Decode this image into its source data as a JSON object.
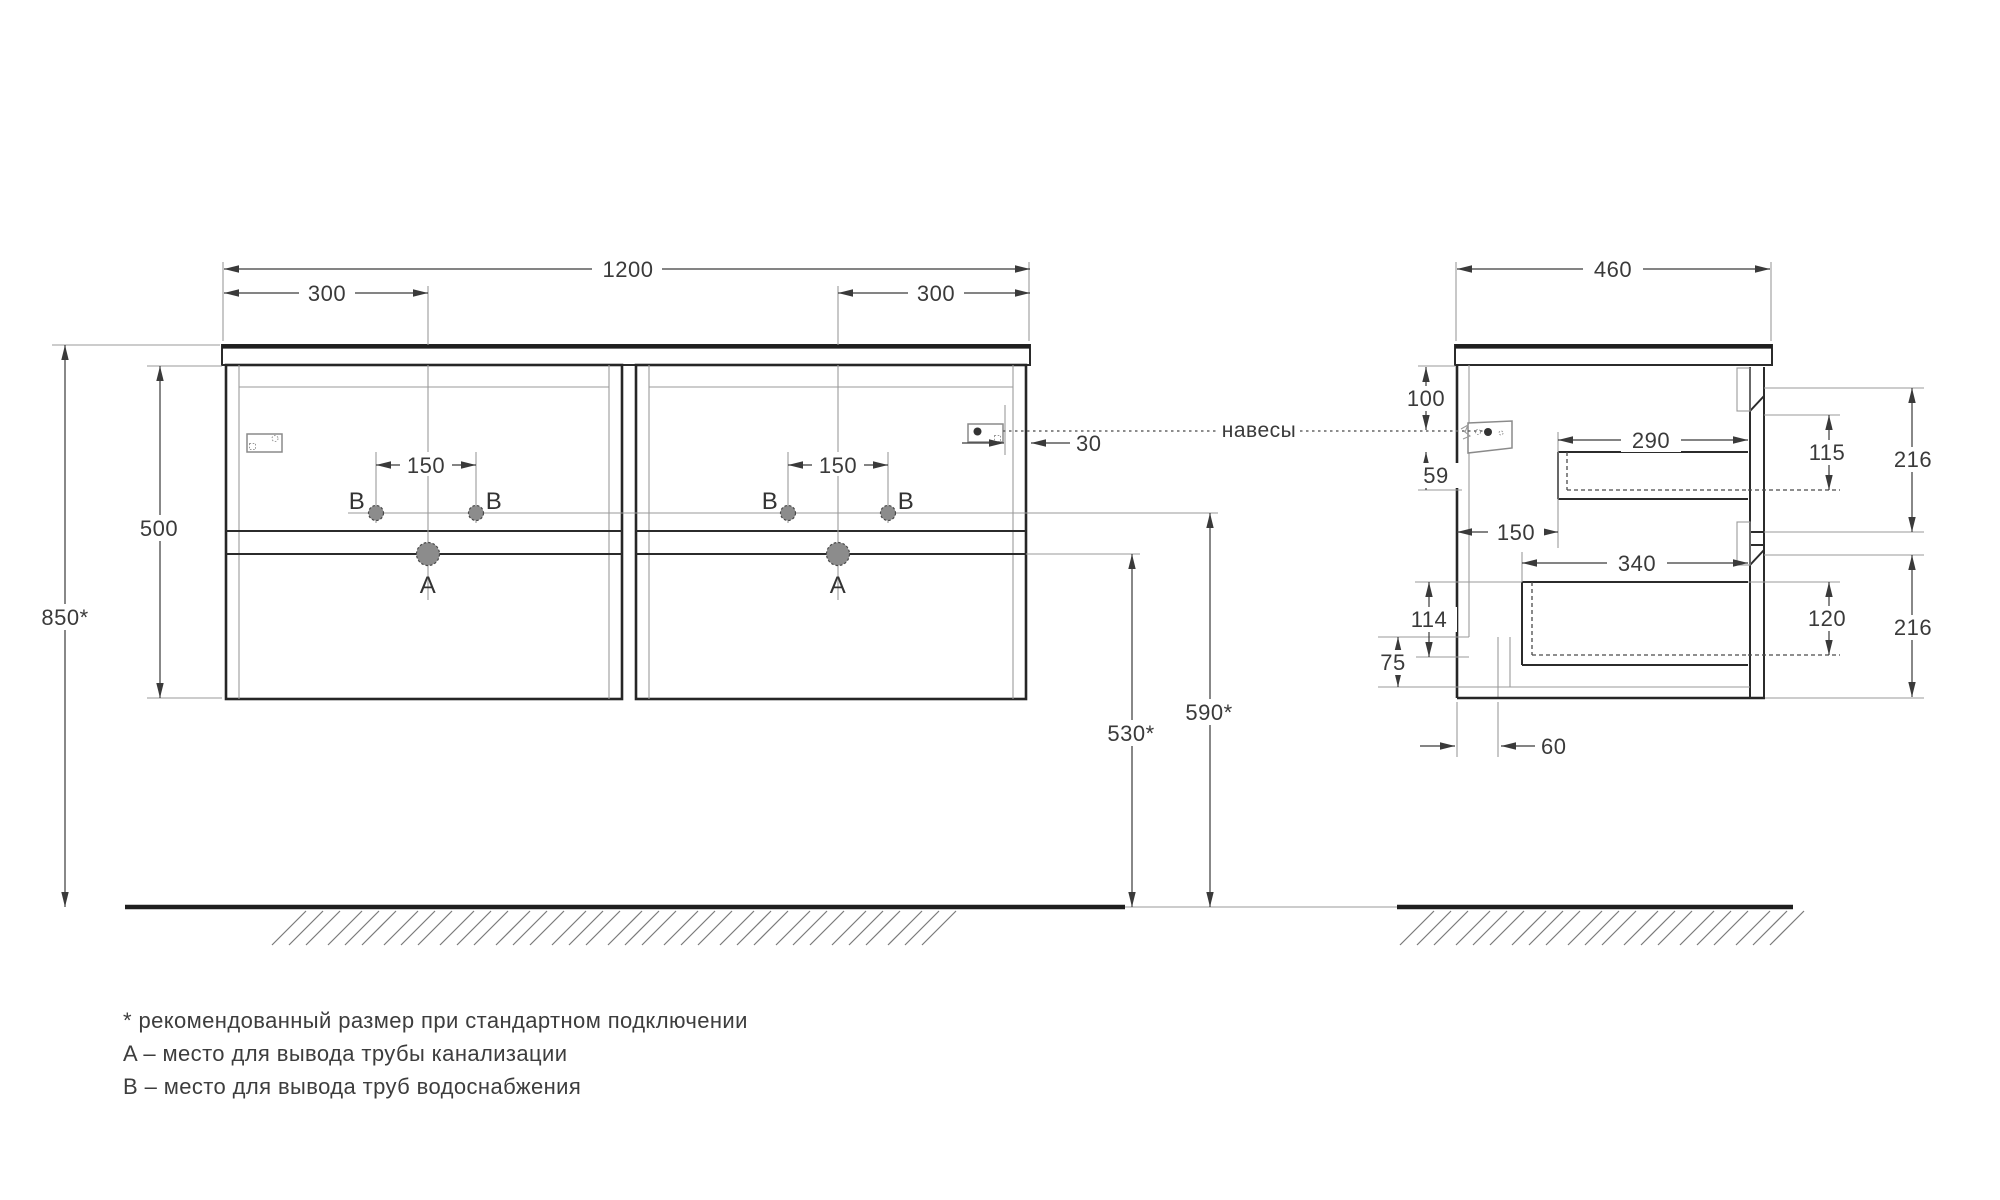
{
  "drawing": {
    "front_view": {
      "dims": {
        "overall_width": "1200",
        "left_offset": "300",
        "right_offset": "300",
        "holes_spacing_left": "150",
        "holes_spacing_right": "150",
        "cabinet_height": "500",
        "mount_height": "850*",
        "hanger_offset": "30",
        "drain_height": "530*",
        "supply_height": "590*"
      },
      "labels": {
        "b1": "B",
        "b2": "B",
        "b3": "B",
        "b4": "B",
        "a1": "A",
        "a2": "A"
      }
    },
    "side_view": {
      "dims": {
        "depth": "460",
        "top_clearance": "100",
        "bracket_gap": "59",
        "drawer_setback": "150",
        "upper_drawer_depth": "290",
        "lower_drawer_depth": "340",
        "upper_inner_height": "115",
        "upper_front_height": "216",
        "lower_inner_height": "120",
        "lower_front_height": "216",
        "back_clearance": "114",
        "notch_height": "75",
        "notch_depth": "60"
      }
    },
    "callout": {
      "hangers": "навесы"
    },
    "legend": {
      "line1": "* рекомендованный размер при стандартном подключении",
      "line2": "A – место для вывода трубы канализации",
      "line3": "B – место для вывода труб водоснабжения"
    },
    "colors": {
      "line": "#2b2b2b",
      "thin": "#9a9a9a",
      "hole_fill": "#8c8c8c",
      "text": "#3a3a3a"
    }
  }
}
